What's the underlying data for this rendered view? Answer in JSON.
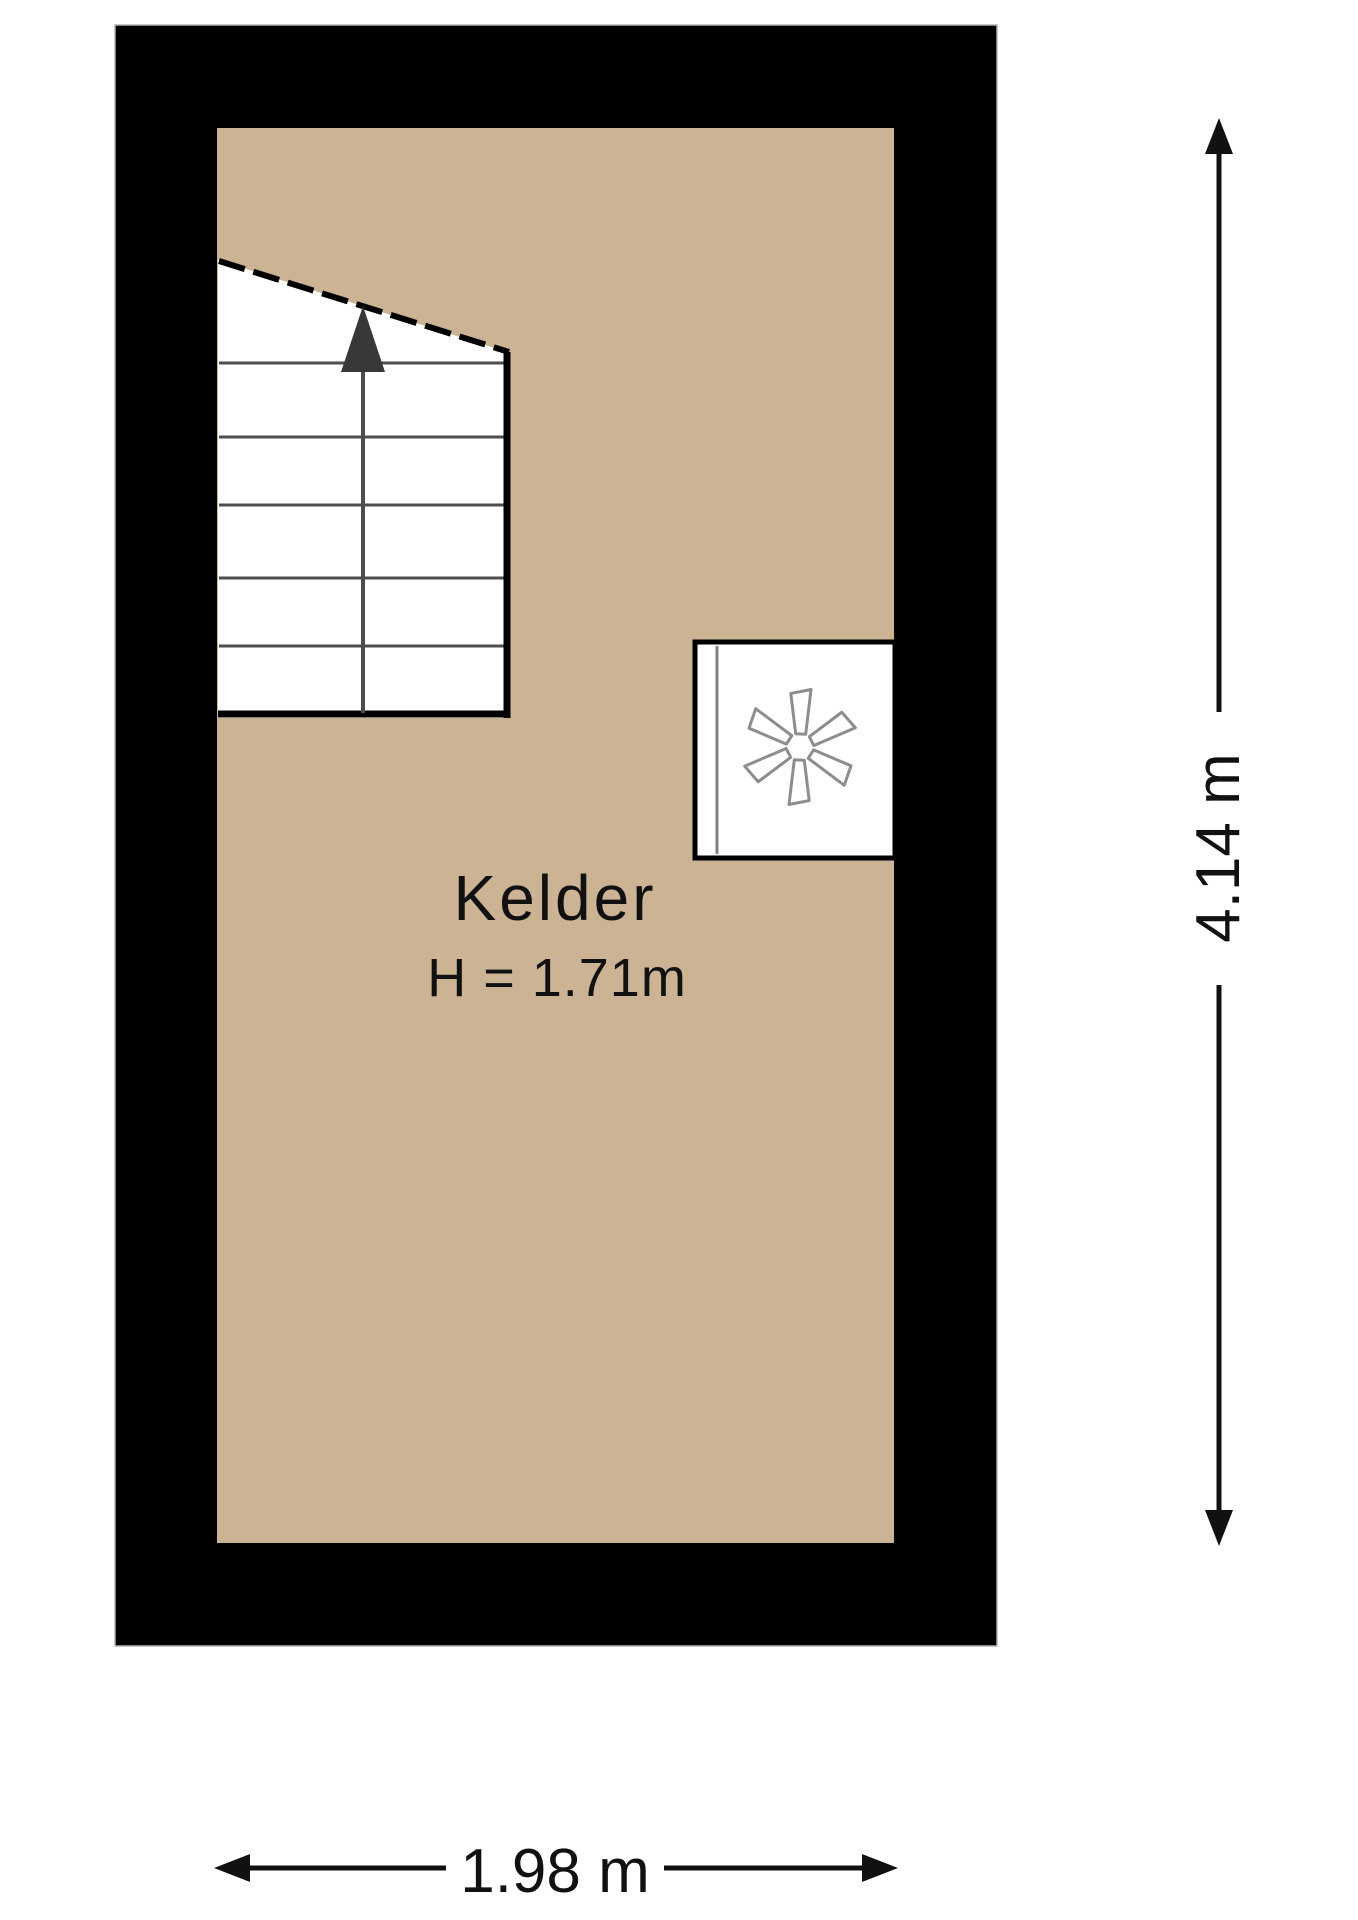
{
  "floorplan": {
    "room": {
      "name": "Kelder",
      "ceiling_height": "H = 1.71m"
    },
    "dimensions": {
      "vertical": "4.14 m",
      "horizontal": "1.98 m"
    },
    "colors": {
      "wall": "#000000",
      "floor": "#cbb394",
      "background": "#ffffff",
      "stair_line": "#4d4d4d",
      "stair_arrow": "#383838",
      "fan_outline": "#8d8d8d",
      "dimension": "#111111",
      "text": "#111111"
    },
    "icons": {
      "stairs_direction": "up-arrow-icon",
      "appliance": "fan-icon"
    }
  }
}
